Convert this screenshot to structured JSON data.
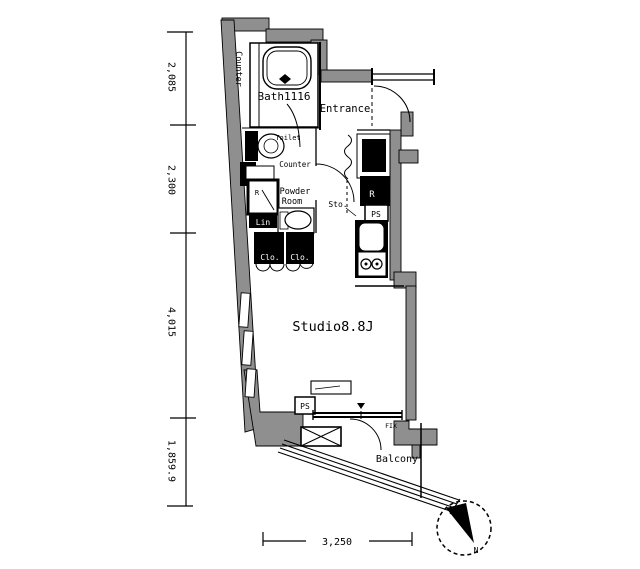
{
  "plan": {
    "rooms": {
      "bath": "Bath1116",
      "entrance": "Entrance",
      "toilet": "Toilet",
      "counter_wall": "Counter",
      "counter_small": "Counter",
      "powder_line1": "Powder",
      "powder_line2": "Room",
      "studio": "Studio8.8J",
      "balcony": "Balcony",
      "storage": "Sto."
    },
    "fixtures": {
      "closet_left": "Clo.",
      "closet_right": "Clo.",
      "linen": "Lin",
      "refrigerator": "R",
      "r_closet": "R",
      "ps_kitchen": "PS",
      "ps_studio": "PS",
      "fix_window": "FIX"
    },
    "dimensions": {
      "left": [
        "2,085",
        "2,300",
        "4,015",
        "1,859.9"
      ],
      "bottom": "3,250"
    },
    "compass": {
      "north": "N"
    },
    "colors": {
      "wall": "#8f8f8f",
      "line": "#000000",
      "bg": "#ffffff"
    }
  }
}
